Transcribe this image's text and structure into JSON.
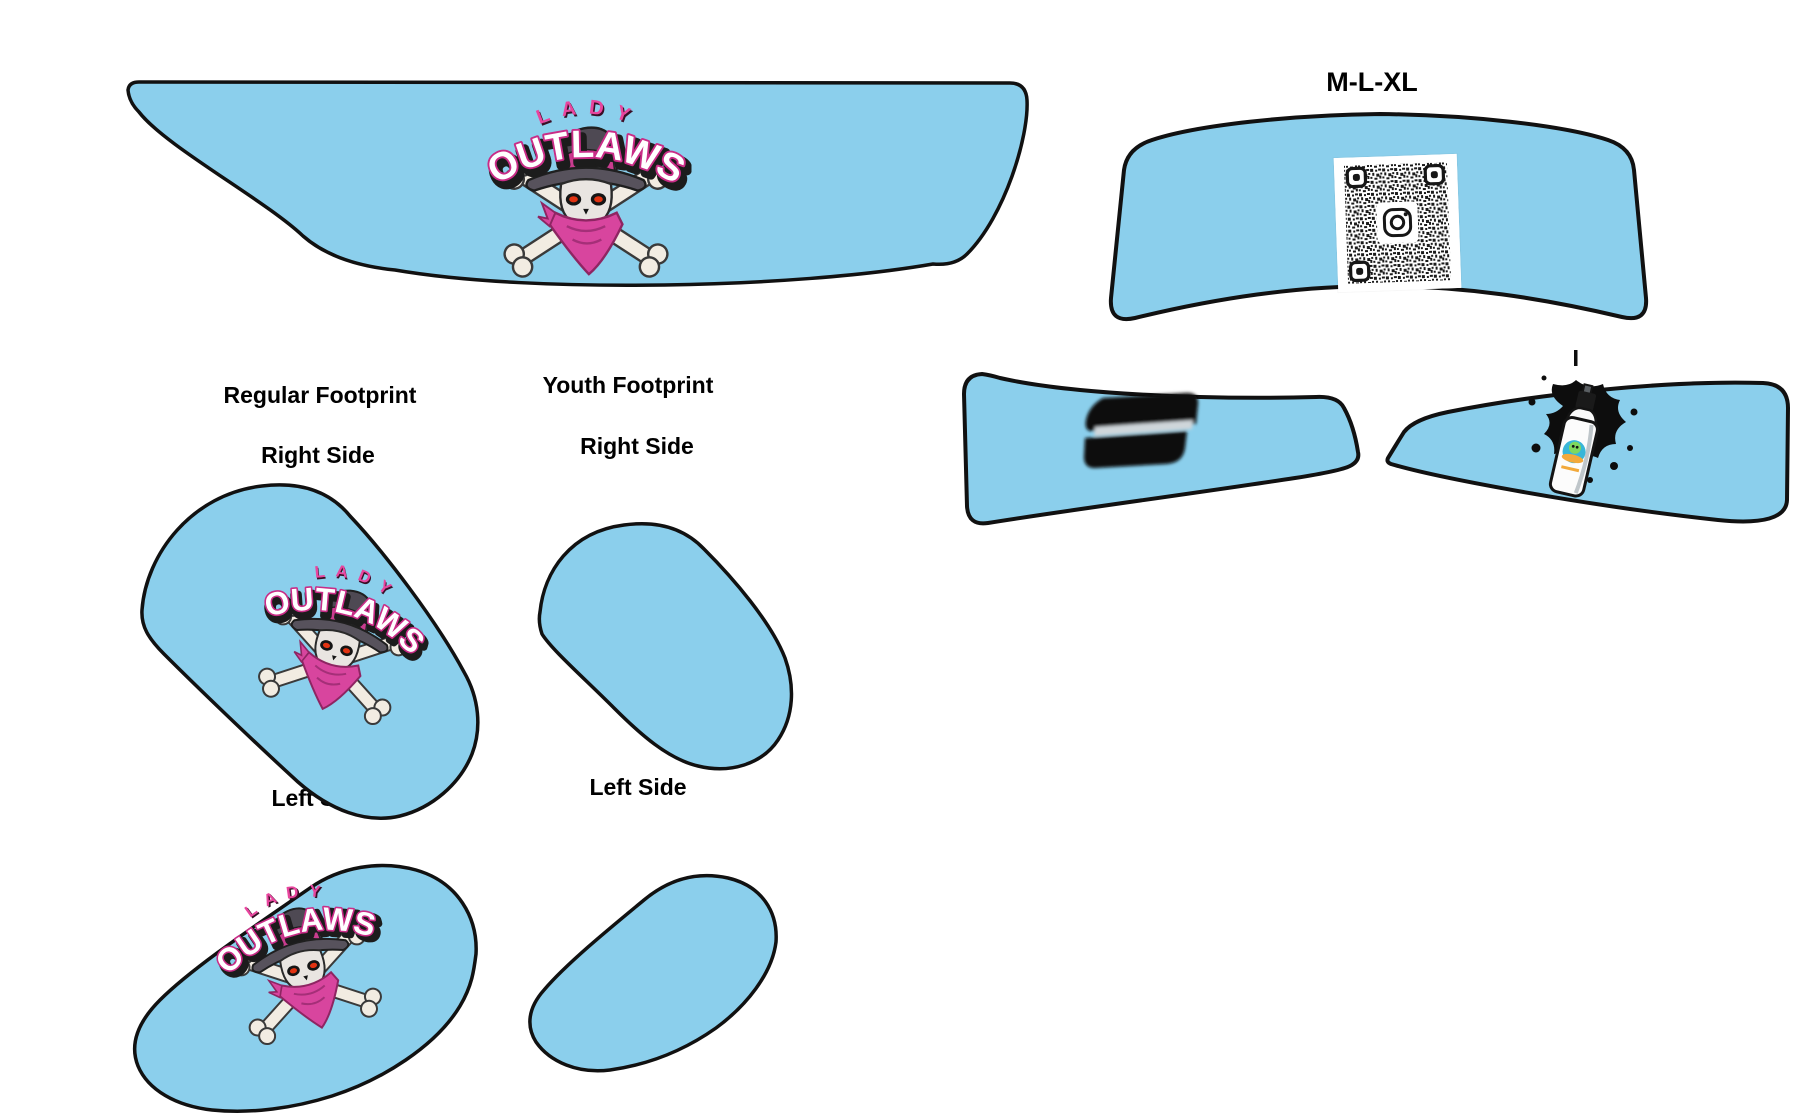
{
  "canvas": {
    "width": 1800,
    "height": 1116,
    "background": "#ffffff"
  },
  "size_label": "M-L-XL",
  "sections": {
    "regular": {
      "heading": "Regular Footprint",
      "right": "Right Side",
      "left": "Left Side"
    },
    "youth": {
      "heading": "Youth Footprint",
      "right": "Right Side",
      "left": "Left Side"
    }
  },
  "logo": {
    "top_text": "LADY",
    "main_text": "OUTLAWS"
  },
  "colors": {
    "panel_fill": "#8BCFEC",
    "panel_outline": "#111111",
    "label_text": "#000000",
    "logo_lady_pink": "#E8459E",
    "logo_outline_pink": "#C92C87",
    "logo_shadow": "#1C1C1C",
    "logo_white": "#FFFFFF",
    "hat_gray": "#4E4953",
    "bandana_pink": "#D8459E",
    "bone_white": "#F2ECE2",
    "eye_red": "#E23312",
    "qr_ink": "#1B1B1B",
    "splatter_black": "#0D0D0D",
    "s_logo_black": "#070707"
  },
  "pieces": [
    {
      "name": "front-panel-large",
      "decoration": "lady-outlaws-logo"
    },
    {
      "name": "front-panel-m-l-xl",
      "decoration": "qr-code-with-instagram-icon"
    },
    {
      "name": "side-band-left",
      "decoration": "s-logo"
    },
    {
      "name": "side-band-right",
      "decoration": "spray-can-with-splatter"
    },
    {
      "name": "regular-right-side",
      "decoration": "lady-outlaws-logo"
    },
    {
      "name": "youth-right-side",
      "decoration": "none"
    },
    {
      "name": "regular-left-side",
      "decoration": "lady-outlaws-logo"
    },
    {
      "name": "youth-left-side",
      "decoration": "none"
    }
  ]
}
